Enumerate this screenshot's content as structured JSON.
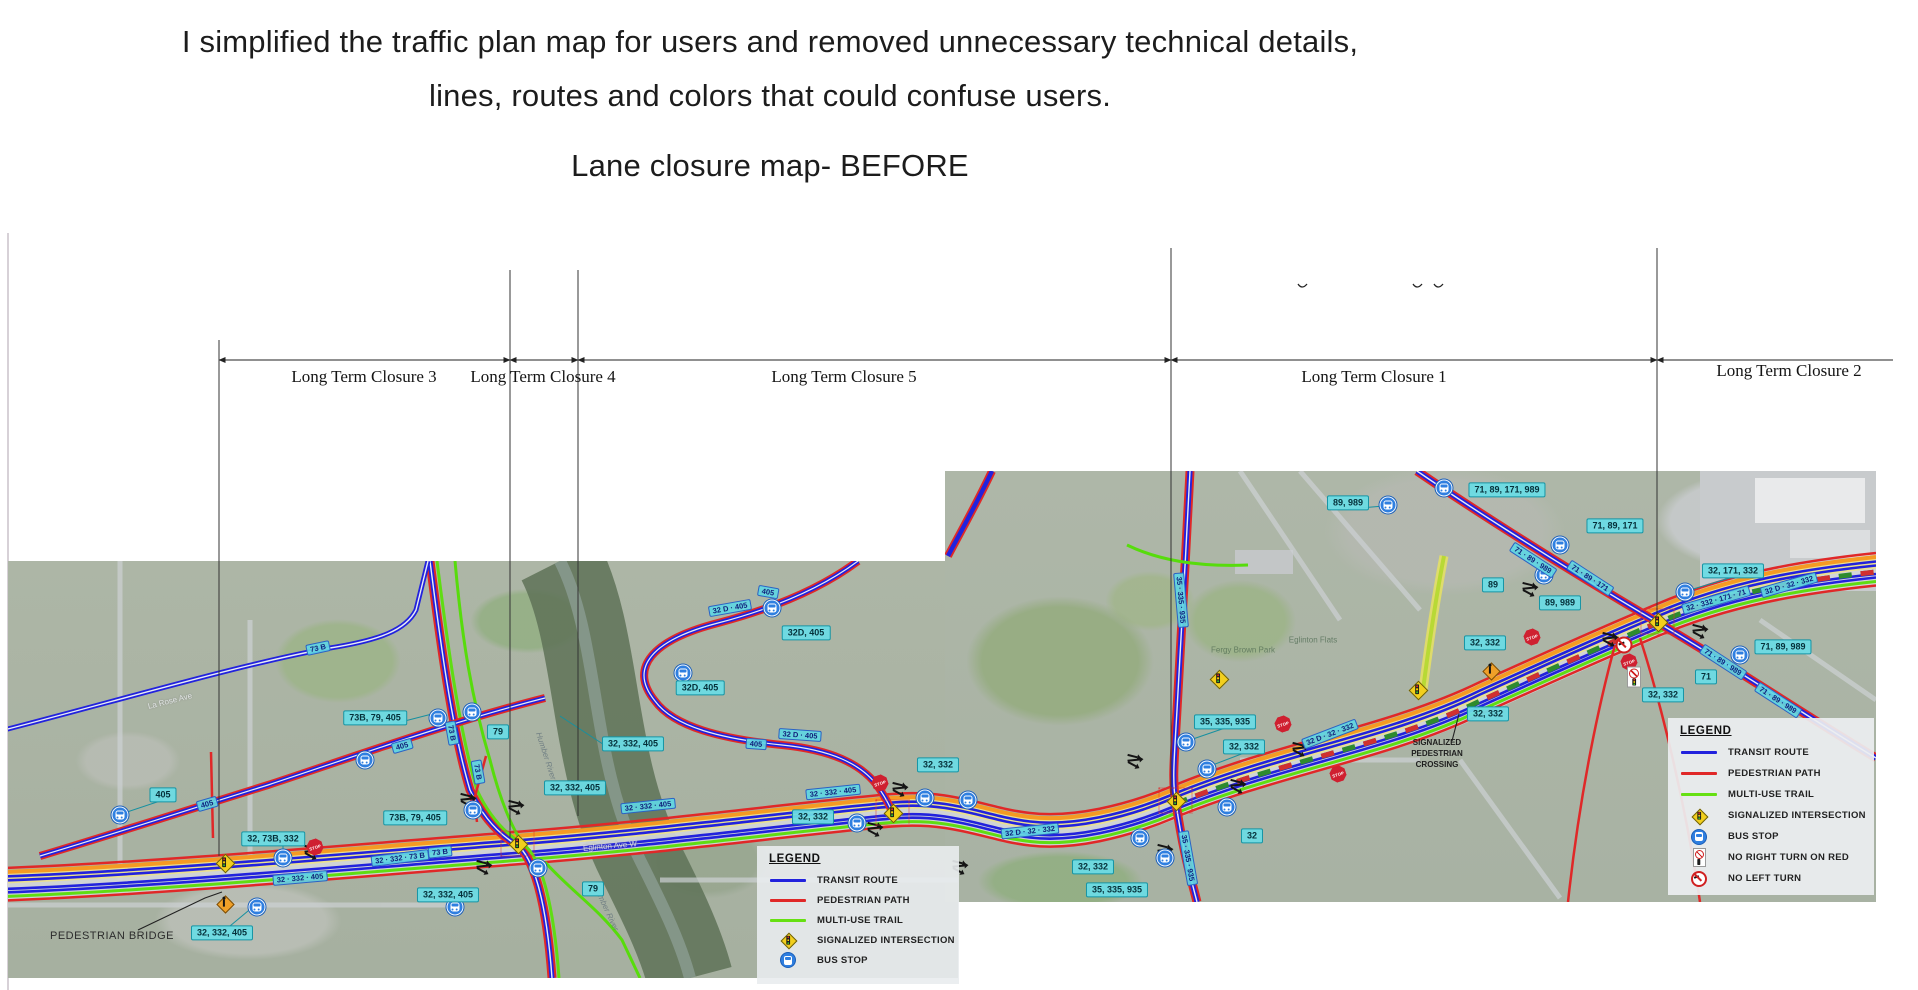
{
  "header": {
    "title_line1": "I simplified the traffic plan map for users and removed unnecessary technical details,",
    "title_line2": "lines, routes and colors that could confuse users.",
    "subtitle": "Lane closure map- BEFORE"
  },
  "colors": {
    "transit_route": "#2222dd",
    "pedestrian_path": "#e02828",
    "multi_use_trail": "#66e012",
    "corridor_orange": "#f59a23",
    "corridor_yellow": "#ece28a",
    "closure_dashed_green": "#2e8b2e",
    "callout_bg": "#6cdbe4",
    "callout_border": "#1795a5",
    "stop_sign_red": "#cf2030",
    "bus_stop_blue": "#2f7fe0",
    "signal_yellow": "#f2cf1d"
  },
  "closure_diagram": {
    "labels": [
      {
        "text": "Long Term Closure 3",
        "x": 364,
        "y": 377
      },
      {
        "text": "Long Term Closure 4",
        "x": 543,
        "y": 377
      },
      {
        "text": "Long Term Closure 5",
        "x": 844,
        "y": 377
      },
      {
        "text": "Long Term Closure 1",
        "x": 1374,
        "y": 377
      },
      {
        "text": "Long Term Closure 2",
        "x": 1789,
        "y": 371
      }
    ]
  },
  "legend_main": {
    "title": "LEGEND",
    "items": [
      {
        "label": "TRANSIT ROUTE",
        "swatch": "line",
        "color": "#2222dd"
      },
      {
        "label": "PEDESTRIAN PATH",
        "swatch": "line",
        "color": "#e02828"
      },
      {
        "label": "MULTI-USE TRAIL",
        "swatch": "line",
        "color": "#66e012"
      },
      {
        "label": "SIGNALIZED INTERSECTION",
        "swatch": "signal"
      },
      {
        "label": "BUS STOP",
        "swatch": "bus"
      }
    ]
  },
  "legend_right": {
    "title": "LEGEND",
    "items": [
      {
        "label": "TRANSIT ROUTE",
        "swatch": "line",
        "color": "#2222dd"
      },
      {
        "label": "PEDESTRIAN PATH",
        "swatch": "line",
        "color": "#e02828"
      },
      {
        "label": "MULTI-USE TRAIL",
        "swatch": "line",
        "color": "#66e012"
      },
      {
        "label": "SIGNALIZED INTERSECTION",
        "swatch": "signal"
      },
      {
        "label": "BUS STOP",
        "swatch": "bus"
      },
      {
        "label": "NO RIGHT TURN ON RED",
        "swatch": "nrtor"
      },
      {
        "label": "NO LEFT TURN",
        "swatch": "nlt"
      }
    ]
  },
  "map": {
    "annotations": {
      "pedestrian_bridge": "PEDESTRIAN BRIDGE",
      "signalized_pedestrian_crossing": "SIGNALIZED PEDESTRIAN CROSSING"
    },
    "stop_sign_text": "STOP",
    "faint_labels": [
      {
        "text": "Humber River",
        "x": 546,
        "y": 756,
        "a": 72
      },
      {
        "text": "Humber River",
        "x": 606,
        "y": 908,
        "a": 65
      },
      {
        "text": "Fergy Brown Park",
        "x": 1243,
        "y": 650,
        "a": 0,
        "c": "park"
      },
      {
        "text": "Eglinton Flats",
        "x": 1313,
        "y": 640,
        "a": 0,
        "c": "park"
      },
      {
        "text": "La Rose Ave",
        "x": 170,
        "y": 701,
        "a": -14,
        "c": "street"
      },
      {
        "text": "Eglinton Ave W",
        "x": 610,
        "y": 846,
        "a": -5,
        "c": "street"
      }
    ],
    "route_boxes": [
      {
        "t": "405",
        "x": 163,
        "y": 795
      },
      {
        "t": "73B, 79, 405",
        "x": 375,
        "y": 718
      },
      {
        "t": "73B, 79, 405",
        "x": 415,
        "y": 818
      },
      {
        "t": "32, 73B, 332",
        "x": 273,
        "y": 839
      },
      {
        "t": "32, 332, 405",
        "x": 448,
        "y": 895
      },
      {
        "t": "32, 332, 405",
        "x": 222,
        "y": 933
      },
      {
        "t": "79",
        "x": 498,
        "y": 732
      },
      {
        "t": "79",
        "x": 593,
        "y": 889
      },
      {
        "t": "32, 332, 405",
        "x": 633,
        "y": 744
      },
      {
        "t": "32, 332, 405",
        "x": 575,
        "y": 788
      },
      {
        "t": "32D, 405",
        "x": 700,
        "y": 688
      },
      {
        "t": "32D, 405",
        "x": 806,
        "y": 633
      },
      {
        "t": "32, 332",
        "x": 938,
        "y": 765
      },
      {
        "t": "32, 332",
        "x": 813,
        "y": 817
      },
      {
        "t": "35, 335, 935",
        "x": 1225,
        "y": 722
      },
      {
        "t": "32, 332",
        "x": 1244,
        "y": 747
      },
      {
        "t": "32",
        "x": 1252,
        "y": 836
      },
      {
        "t": "32, 332",
        "x": 1093,
        "y": 867
      },
      {
        "t": "35, 335, 935",
        "x": 1117,
        "y": 890
      },
      {
        "t": "89, 989",
        "x": 1348,
        "y": 503
      },
      {
        "t": "71, 89, 171, 989",
        "x": 1507,
        "y": 490
      },
      {
        "t": "71, 89, 171",
        "x": 1615,
        "y": 526
      },
      {
        "t": "89",
        "x": 1493,
        "y": 585
      },
      {
        "t": "89, 989",
        "x": 1560,
        "y": 603
      },
      {
        "t": "32, 171, 332",
        "x": 1733,
        "y": 571
      },
      {
        "t": "32, 332",
        "x": 1485,
        "y": 643
      },
      {
        "t": "71, 89, 989",
        "x": 1783,
        "y": 647
      },
      {
        "t": "71",
        "x": 1706,
        "y": 677
      },
      {
        "t": "32, 332",
        "x": 1663,
        "y": 695
      },
      {
        "t": "32, 332",
        "x": 1488,
        "y": 714
      }
    ],
    "line_badges": [
      {
        "t": "73 B",
        "x": 318,
        "y": 648,
        "a": -12
      },
      {
        "t": "405",
        "x": 207,
        "y": 804,
        "a": -16
      },
      {
        "t": "405",
        "x": 402,
        "y": 746,
        "a": -16
      },
      {
        "t": "73 B",
        "x": 452,
        "y": 733,
        "a": 80
      },
      {
        "t": "73 B",
        "x": 478,
        "y": 772,
        "a": 80
      },
      {
        "t": "73 B",
        "x": 440,
        "y": 852,
        "a": -6
      },
      {
        "t": "32 · 332 · 73 B",
        "x": 400,
        "y": 858,
        "a": -7
      },
      {
        "t": "32 · 332 · 405",
        "x": 300,
        "y": 878,
        "a": -5
      },
      {
        "t": "32 · 332 · 405",
        "x": 648,
        "y": 806,
        "a": -6
      },
      {
        "t": "32 · 332 · 405",
        "x": 833,
        "y": 792,
        "a": -6
      },
      {
        "t": "405",
        "x": 768,
        "y": 592,
        "a": 10
      },
      {
        "t": "32 D · 405",
        "x": 730,
        "y": 608,
        "a": -10
      },
      {
        "t": "32 D · 405",
        "x": 800,
        "y": 735,
        "a": 4
      },
      {
        "t": "405",
        "x": 756,
        "y": 744,
        "a": 4
      },
      {
        "t": "35 · 335 · 935",
        "x": 1181,
        "y": 600,
        "a": 85
      },
      {
        "t": "35 · 335 · 935",
        "x": 1188,
        "y": 858,
        "a": 80
      },
      {
        "t": "32 D · 32 · 332",
        "x": 1030,
        "y": 831,
        "a": -6
      },
      {
        "t": "32 D · 32 · 332",
        "x": 1330,
        "y": 734,
        "a": -21
      },
      {
        "t": "32 · 332 · 171 · 71",
        "x": 1716,
        "y": 600,
        "a": -16
      },
      {
        "t": "32 D · 32 · 332",
        "x": 1789,
        "y": 585,
        "a": -16
      },
      {
        "t": "71 · 89 · 989",
        "x": 1533,
        "y": 560,
        "a": 33
      },
      {
        "t": "71 · 89 · 171",
        "x": 1590,
        "y": 578,
        "a": 33
      },
      {
        "t": "71 · 89 · 989",
        "x": 1723,
        "y": 662,
        "a": 33
      },
      {
        "t": "71 · 89 · 989",
        "x": 1778,
        "y": 700,
        "a": 33
      }
    ],
    "bus_stops": [
      {
        "x": 120,
        "y": 815
      },
      {
        "x": 365,
        "y": 760
      },
      {
        "x": 438,
        "y": 718
      },
      {
        "x": 472,
        "y": 712
      },
      {
        "x": 283,
        "y": 858
      },
      {
        "x": 257,
        "y": 907
      },
      {
        "x": 455,
        "y": 907
      },
      {
        "x": 473,
        "y": 810
      },
      {
        "x": 538,
        "y": 868
      },
      {
        "x": 683,
        "y": 673
      },
      {
        "x": 772,
        "y": 608
      },
      {
        "x": 857,
        "y": 823
      },
      {
        "x": 925,
        "y": 798
      },
      {
        "x": 968,
        "y": 800
      },
      {
        "x": 1140,
        "y": 838
      },
      {
        "x": 1165,
        "y": 858
      },
      {
        "x": 1186,
        "y": 742
      },
      {
        "x": 1207,
        "y": 769
      },
      {
        "x": 1227,
        "y": 807
      },
      {
        "x": 1388,
        "y": 505
      },
      {
        "x": 1444,
        "y": 488
      },
      {
        "x": 1560,
        "y": 545
      },
      {
        "x": 1544,
        "y": 575
      },
      {
        "x": 1685,
        "y": 592
      },
      {
        "x": 1740,
        "y": 655
      }
    ],
    "stop_signs": [
      {
        "x": 315,
        "y": 847
      },
      {
        "x": 880,
        "y": 783
      },
      {
        "x": 1283,
        "y": 724
      },
      {
        "x": 1338,
        "y": 774
      },
      {
        "x": 1532,
        "y": 637
      },
      {
        "x": 1629,
        "y": 662
      }
    ],
    "signals": [
      {
        "x": 517,
        "y": 843,
        "boxed": true
      },
      {
        "x": 892,
        "y": 812,
        "boxed": true
      },
      {
        "x": 1175,
        "y": 800,
        "boxed": true
      },
      {
        "x": 1657,
        "y": 621,
        "boxed": true
      },
      {
        "x": 1218,
        "y": 678
      },
      {
        "x": 224,
        "y": 862
      },
      {
        "x": 1417,
        "y": 689
      }
    ],
    "ped_crossings": [
      {
        "x": 224,
        "y": 903
      },
      {
        "x": 1490,
        "y": 670
      }
    ],
    "no_right_turn_on_red": [
      {
        "x": 1634,
        "y": 677
      }
    ],
    "no_left_turn": [
      {
        "x": 1624,
        "y": 645
      }
    ],
    "turn_arrow_clusters": [
      {
        "x": 312,
        "y": 851
      },
      {
        "x": 468,
        "y": 799
      },
      {
        "x": 484,
        "y": 866
      },
      {
        "x": 516,
        "y": 806
      },
      {
        "x": 875,
        "y": 828
      },
      {
        "x": 900,
        "y": 788
      },
      {
        "x": 960,
        "y": 866
      },
      {
        "x": 1135,
        "y": 760
      },
      {
        "x": 1165,
        "y": 850
      },
      {
        "x": 1238,
        "y": 785
      },
      {
        "x": 1300,
        "y": 748
      },
      {
        "x": 1530,
        "y": 588
      },
      {
        "x": 1610,
        "y": 638
      },
      {
        "x": 1700,
        "y": 630
      }
    ]
  }
}
